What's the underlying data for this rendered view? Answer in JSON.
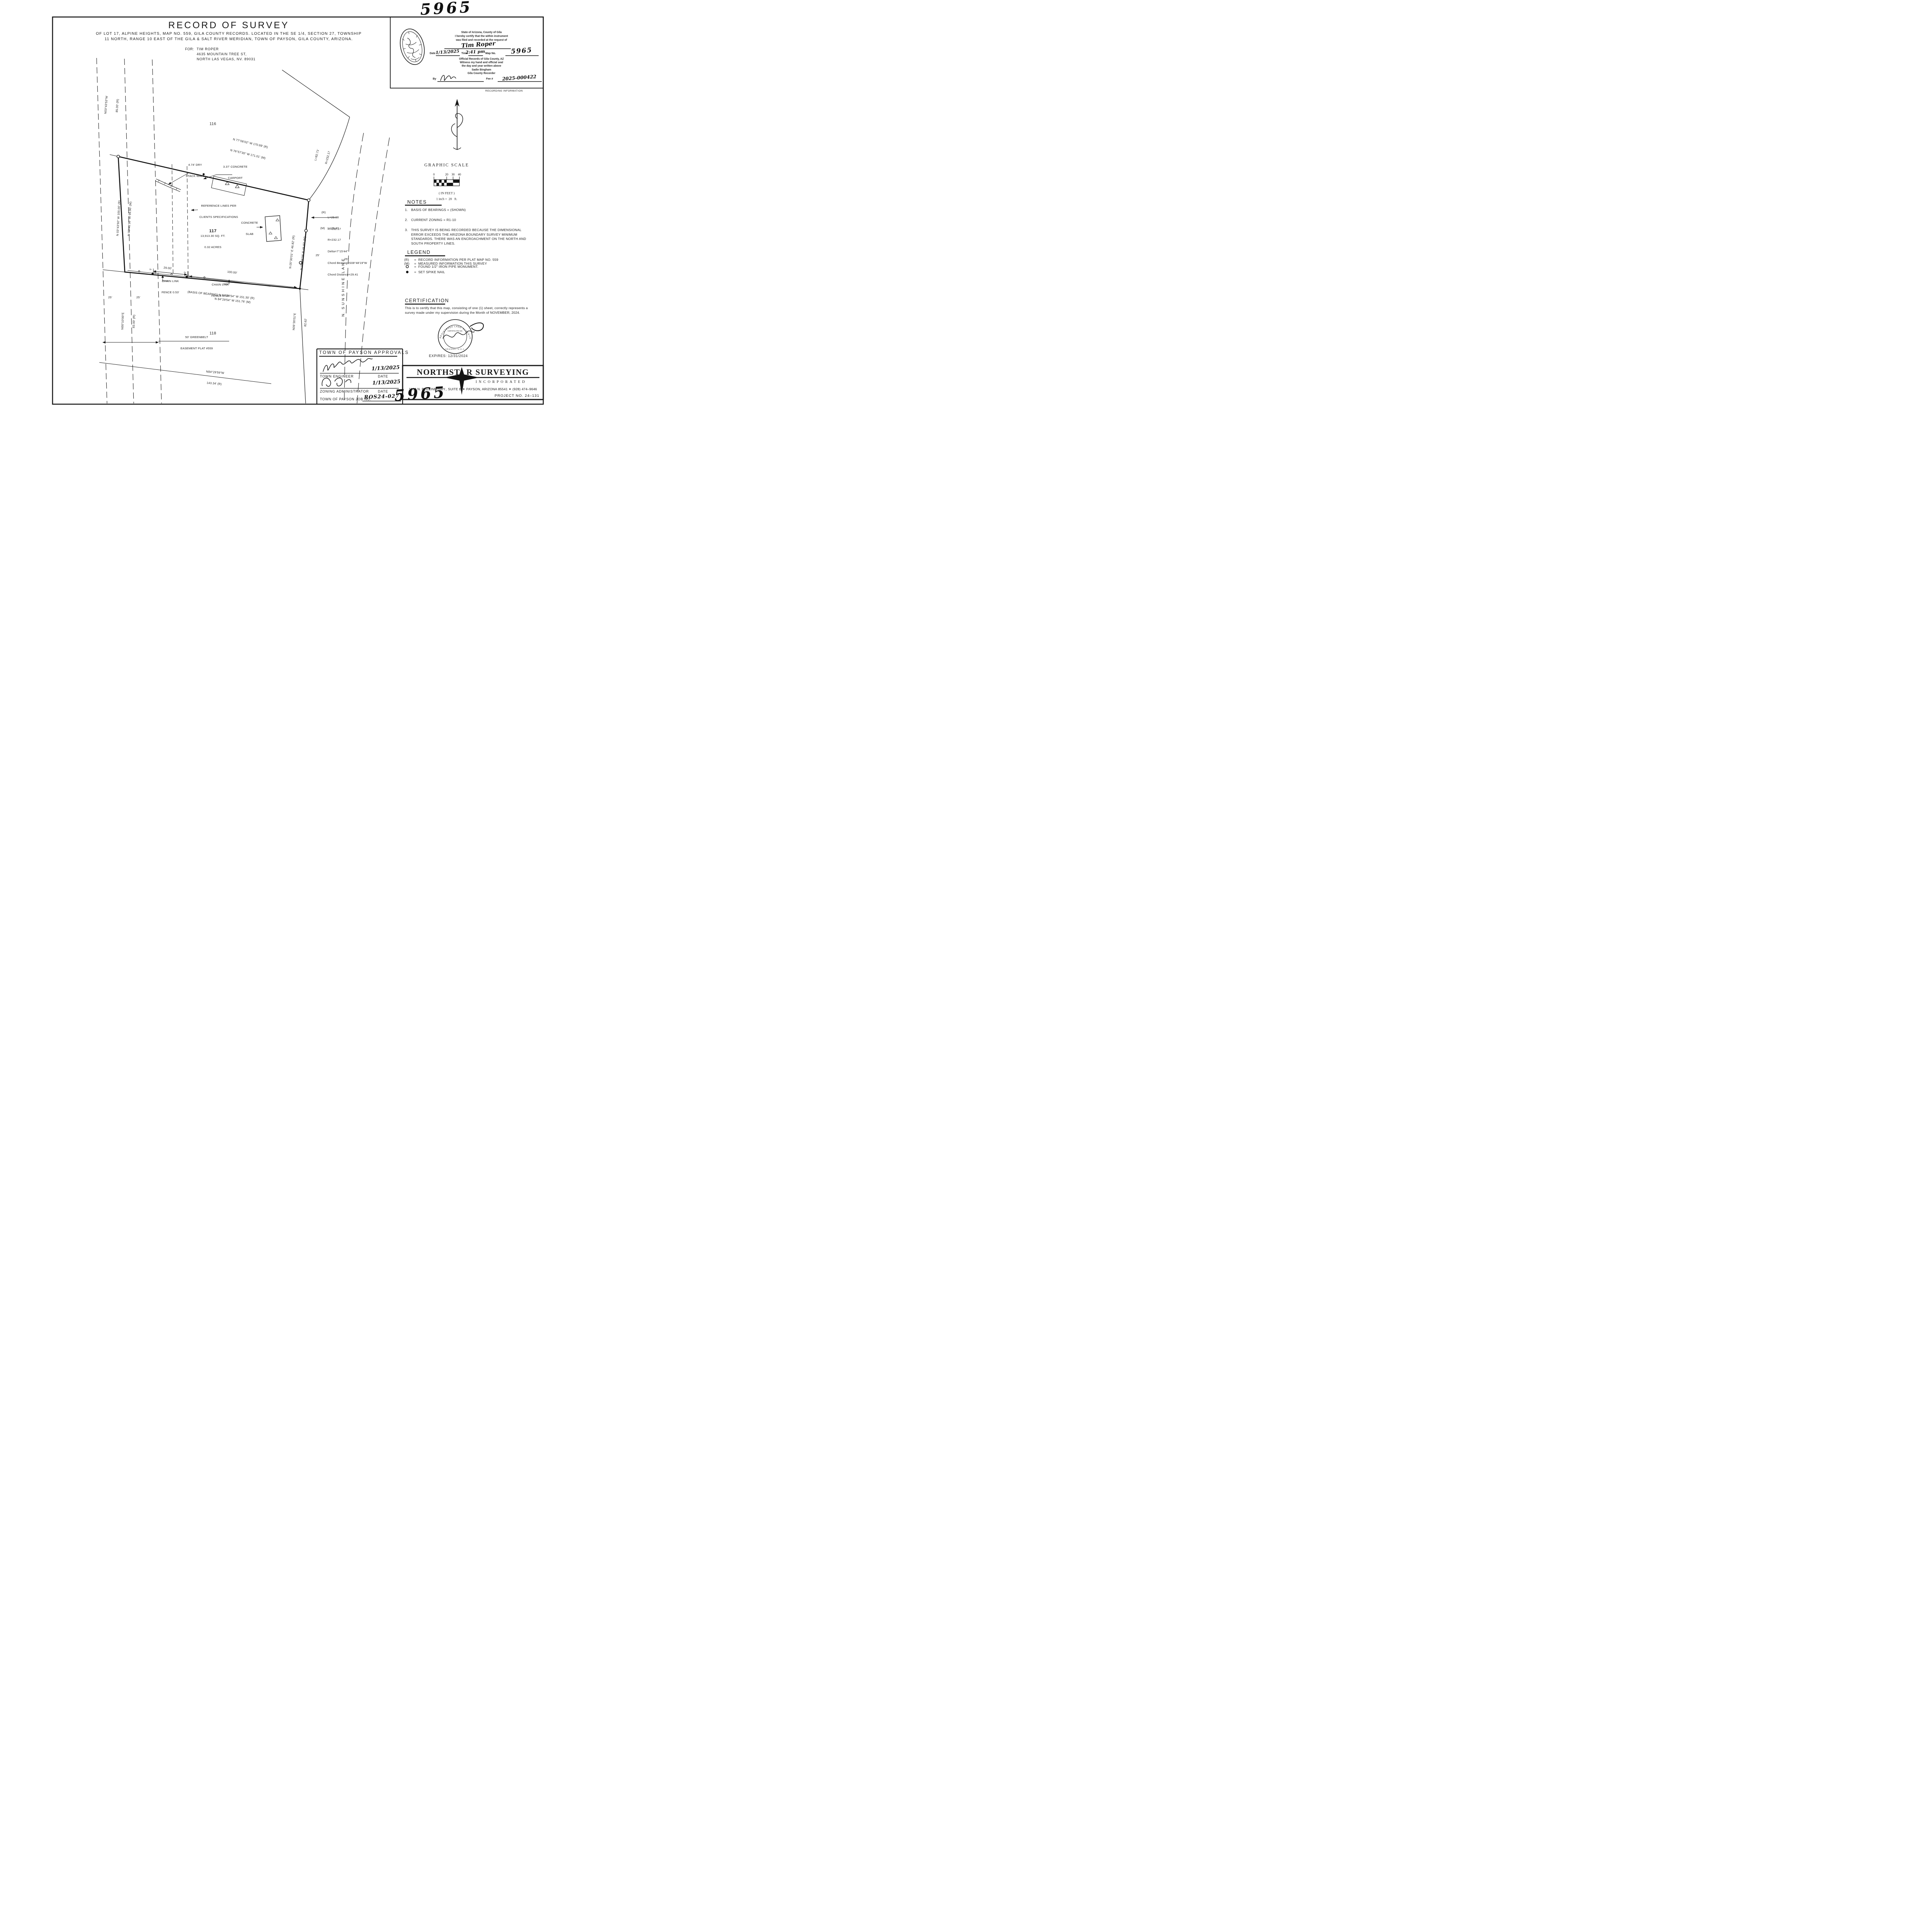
{
  "sheet": {
    "map_no_top": "5965",
    "map_no_bottom": "5965"
  },
  "header": {
    "title": "RECORD OF SURVEY",
    "subtitle_line1": "OF LOT 17, ALPINE HEIGHTS, MAP NO. 559, GILA COUNTY RECORDS. LOCATED IN THE SE 1/4, SECTION 27, TOWNSHIP",
    "subtitle_line2": "11 NORTH, RANGE 10 EAST OF THE GILA & SALT RIVER MERIDIAN, TOWN OF PAYSON, GILA COUNTY, ARIZONA.",
    "for_label": "FOR:",
    "client_name": "TIM ROPER",
    "client_address1": "4635 MOUNTAIN TREE ST,",
    "client_address2": "NORTH LAS VEGAS, NV. 89031"
  },
  "recording_stamp": {
    "cert_line1": "State of Arizona, County of Gila",
    "cert_line2": "I hereby certify that the within instrument",
    "cert_line3": "was filed and recorded at the request of",
    "requested_by": "Tim Roper",
    "date_label": "Date",
    "date_value": "1/13/2025",
    "time_label": "Time",
    "time_value": "2:41 pm",
    "map_no_label": "Map No.",
    "map_no_value": "5965",
    "official_line1": "Official Records of Gila County, AZ",
    "official_line2": "Witness my hand and official seal",
    "official_line3": "the day and year written above",
    "recorder_name": "Sadie Bingham",
    "recorder_title": "Gila County Recorder",
    "by_label": "By",
    "fee_label": "Fee #",
    "fee_value": "2025-000422",
    "caption": "RECORDING INFORMATION"
  },
  "graphic_scale": {
    "title": "GRAPHIC SCALE",
    "ticks": [
      "0",
      "20",
      "30",
      "40"
    ],
    "in_feet": "( IN FEET )",
    "ratio": "1 inch =  20   ft."
  },
  "notes": {
    "heading": "NOTES",
    "items": [
      {
        "no": "1.",
        "text": "BASIS OF BEARINGS = (SHOWN)"
      },
      {
        "no": "2.",
        "text": "CURRENT ZONING = R1-10"
      },
      {
        "no": "3.",
        "text": "THIS SURVEY IS BEING RECORDED BECAUSE THE DIMENSIONAL ERROR EXCEEDS THE ARIZONA BOUNDARY SURVEY MINIMUM STANDARDS. THERE WAS AN ENCROACHMENT ON THE NORTH AND SOUTH PROPERTY LINES."
      }
    ]
  },
  "legend": {
    "heading": "LEGEND",
    "record_sym": "(R)",
    "record_text": "=  RECORD INFORMATION PER PLAT MAP NO. 559",
    "measured_sym": "(M)",
    "measured_text": "=  MEASURED INFORMATION THIS SURVEY",
    "found_text": "=  FOUND 1/2\" IRON PIPE MONUMENT.",
    "set_text": "=  SET SPIKE NAIL"
  },
  "certification": {
    "heading": "CERTIFICATION",
    "body": "This is to certify that this map, consisting of one (1) sheet, correctly represents a survey made under my supervision during the Month of NOVEMBER, 2024.",
    "seal_arc_text": "REGISTERED LAND SURVEYOR",
    "seal_cert_label": "CERTIFICATE NO.",
    "seal_state": "ARIZONA, U.S.A.",
    "expires": "EXPIRES: 12/31/2024"
  },
  "approvals": {
    "heading": "TOWN OF PAYSON APPROVALS",
    "engineer_label": "TOWN ENGINEER",
    "engineer_date": "1/13/2025",
    "zoning_label": "ZONING ADMINISTRATOR",
    "zoning_date": "1/13/2025",
    "date_label": "DATE",
    "job_label": "TOWN OF PAYSON JOB NO.",
    "job_value": "ROS24-027"
  },
  "firm": {
    "name_pre": "NORTHST",
    "name_post": "R SURVEYING",
    "name_full": "NORTHSTAR SURVEYING",
    "incorporated": "INCORPORATED",
    "address": "1100 N. BEELINE HWY., SUITE B ✦ PAYSON, ARIZONA 85541 ✦ (928) 474–9646",
    "project": "PROJECT NO. 24–131"
  },
  "drawing": {
    "lots": {
      "north": "116",
      "subject": "117",
      "south": "118"
    },
    "subject_area": {
      "sqft": "13,913.30 SQ. FT.",
      "acres": "0.32 ACRES"
    },
    "street": {
      "name": "N.  S U N S H I N E   L A N E"
    },
    "boundary": {
      "north_record": "N 77°06'02\" W 170.69' (R)",
      "north_measured": "N 76°57'35\" W 171.01' (M)",
      "west_north_bearing": "N03°43'53\"W",
      "west_north_length": "85.00' (R)",
      "west_record": "N 03°43'50\" W 100.00' (R)",
      "west_measured": "N 03°41'36\" W 99.90' (M)",
      "west_south_bearing": "N00°10'00\"E",
      "west_south_length": "83.00' (R)",
      "south_basis": "(BASIS OF BEARING) N 84°29'54\" W 151.30' (R)",
      "south_measured": "N 84°29'54\" W 151.76' (M)",
      "east_record": "N 05°30'01\" E 46.82' (R)",
      "east_measured": "N 05°38'28\" E 46.82' (M)",
      "road_bearing": "N05°30'01\"E",
      "road_length": "82.62'",
      "lot118_south_bearing": "N84°29'59\"W",
      "lot118_south_length": "143.34' (R)"
    },
    "curves": {
      "road_l": "L=82.71'",
      "road_r": "R=232.17",
      "record_tag": "(R)",
      "record_l": "L=29.98",
      "record_r": "R=232.17",
      "measured_tag": "(M)",
      "measured_l": "L=29.43",
      "measured_r": "R=232.17",
      "measured_delta": "Delta=7°15'44\"",
      "measured_chord_bearing": "Chord Bearing=S08°48'19\"W",
      "measured_chord_distance": "Chord Distance=29.41"
    },
    "features": {
      "dry_stack_wall_1": "4.74' DRY",
      "dry_stack_wall_2": "STACK WALL",
      "carport_1": "3.37' CONCRETE",
      "carport_2": "CARPORT",
      "reference_1": "REFERENCE LINES PER",
      "reference_2": "CLIENTS SPECIFICATIONS",
      "slab_1": "CONCRETE",
      "slab_2": "SLAB",
      "fence_w_1": "CHAIN LINK",
      "fence_w_2": "FENCE 0.53'",
      "fence_e_1": "CHAIN LINK",
      "fence_e_2": "FENCE 0.58'",
      "greenbelt_1": "50' GREENBELT",
      "greenbelt_2": "EASEMENT PLAT #559"
    },
    "dims": {
      "south_seg_west": "29.00'",
      "south_seg_east": "100.00'",
      "ref_offset_w": "5'",
      "ref_offset_e": "5'",
      "greenbelt_half_w": "25'",
      "greenbelt_half_e": "25'",
      "road_half_w": "25'",
      "road_half_e": "25'"
    }
  }
}
